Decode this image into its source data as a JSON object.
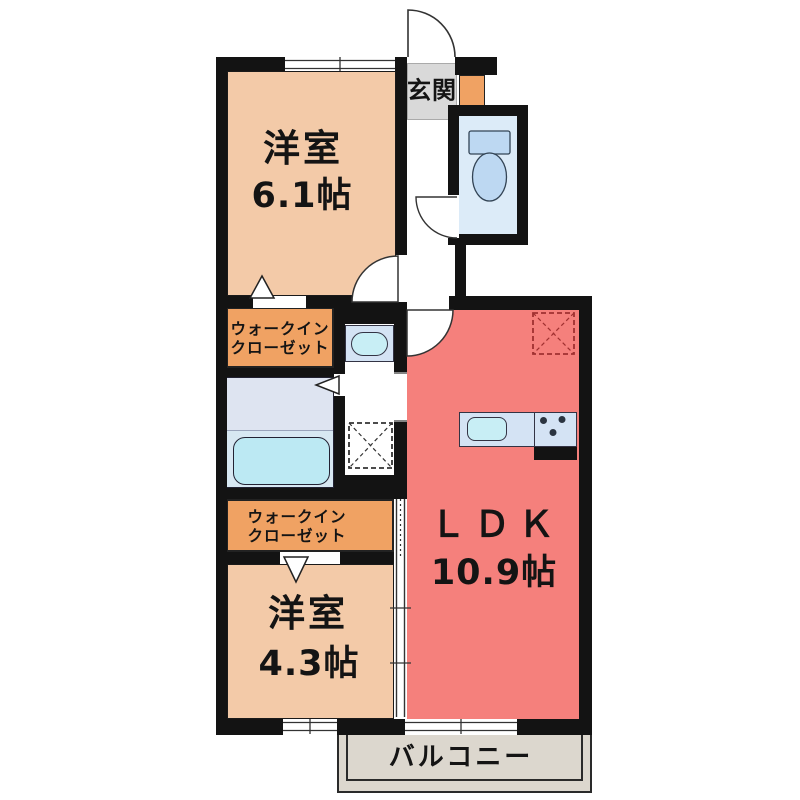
{
  "floor_plan": {
    "rooms": {
      "bedroom_top": {
        "name": "洋室",
        "size": "6.1帖"
      },
      "bedroom_bottom": {
        "name": "洋室",
        "size": "4.3帖"
      },
      "ldk": {
        "name": "ＬＤＫ",
        "size": "10.9帖"
      },
      "walk_in_closet_top": {
        "line1": "ウォークイン",
        "line2": "クローゼット"
      },
      "walk_in_closet_bottom": {
        "line1": "ウォークイン",
        "line2": "クローゼット"
      },
      "entrance": {
        "name": "玄関"
      },
      "balcony": {
        "name": "バルコニー"
      }
    },
    "colors": {
      "wall": "#131313",
      "bedroom": "#f3caa8",
      "closet": "#f0a263",
      "ldk": "#f5807c",
      "bath": "#dee4f1",
      "bathlower": "#d7e8f2",
      "bathtub": "#bce9f3",
      "toilet": "#dcebf8",
      "fixture": "#bdd8f2",
      "counter": "#d4e3f4",
      "sink": "#c8eef5",
      "entrancebg": "#d9d9d9",
      "balconybg": "#dcd7ce"
    }
  }
}
